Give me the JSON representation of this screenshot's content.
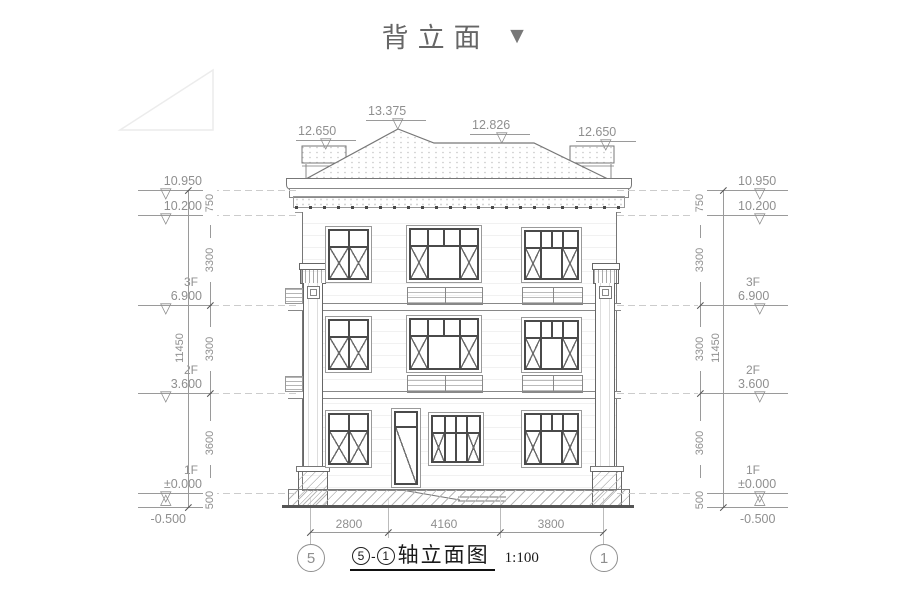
{
  "title": {
    "text": "背立面",
    "arrow": "▼"
  },
  "caption": {
    "axis_from": "5",
    "separator": "-",
    "axis_to": "1",
    "name": "轴立面图",
    "scale": "1:100"
  },
  "roof_levels": [
    {
      "value": "12.650"
    },
    {
      "value": "13.375"
    },
    {
      "value": "12.826"
    },
    {
      "value": "12.650"
    }
  ],
  "levels": [
    {
      "floor": "",
      "value": "10.950"
    },
    {
      "floor": "",
      "value": "10.200"
    },
    {
      "floor": "3F",
      "value": "6.900"
    },
    {
      "floor": "2F",
      "value": "3.600"
    },
    {
      "floor": "1F",
      "value": "±0.000"
    },
    {
      "floor": "",
      "value": "-0.500"
    }
  ],
  "vertical_dims": {
    "segments": [
      "750",
      "3300",
      "3300",
      "3600",
      "500"
    ],
    "overall": "11450"
  },
  "bottom_dims": {
    "segments": [
      "2800",
      "4160",
      "3800"
    ]
  },
  "axes": [
    {
      "label": "5"
    },
    {
      "label": "1"
    }
  ],
  "icons": {
    "elev_down": "▽",
    "elev_up": "△"
  },
  "colors": {
    "line": "#6a6a6a",
    "frame": "#4a4a4a",
    "dim_text": "#8f8f8f",
    "caption": "#1a1a1a",
    "title": "#666666"
  }
}
